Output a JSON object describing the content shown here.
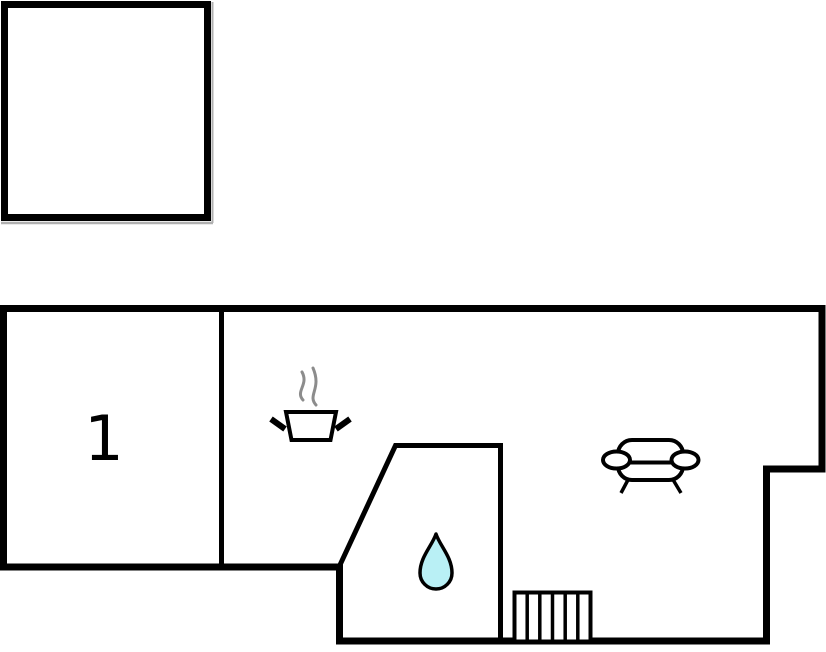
{
  "title": "Floor plan",
  "colors": {
    "wall": "#000000",
    "inner_wall": "#000000",
    "icon_stroke": "#000000",
    "steam": "#8c8c8c",
    "water_fill": "#b9f0f5",
    "shadow": "#b0b0b0",
    "background": "#ffffff"
  },
  "floor_plan": {
    "rooms": [
      {
        "label": "1"
      }
    ],
    "icons": [
      {
        "name": "cooking-pot-icon"
      },
      {
        "name": "steam-icon"
      },
      {
        "name": "sofa-icon"
      },
      {
        "name": "water-drop-icon"
      },
      {
        "name": "stairs-icon"
      }
    ]
  }
}
